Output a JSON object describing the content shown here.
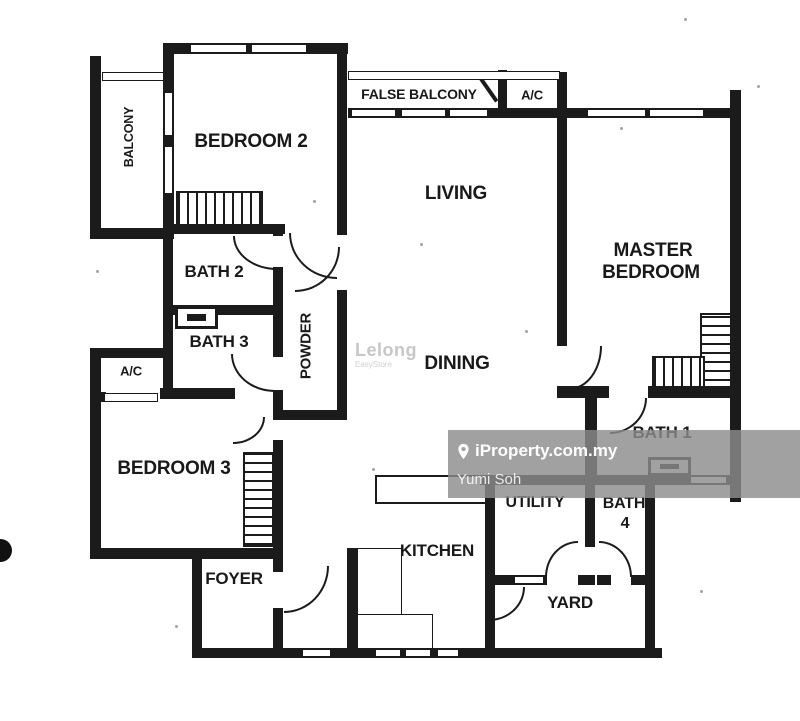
{
  "rooms": {
    "balcony": "BALCONY",
    "bedroom2": "BEDROOM 2",
    "false_balcony": "FALSE BALCONY",
    "ac_top": "A/C",
    "living": "LIVING",
    "master_line1": "MASTER",
    "master_line2": "BEDROOM",
    "bath2": "BATH 2",
    "bath3": "BATH 3",
    "powder": "POWDER",
    "ac_left": "A/C",
    "bedroom3": "BEDROOM 3",
    "dining": "DINING",
    "bath1": "BATH 1",
    "utility": "UTILITY",
    "bath4_line1": "BATH",
    "bath4_line2": "4",
    "kitchen": "KITCHEN",
    "yard": "YARD",
    "foyer": "FOYER"
  },
  "watermarks": {
    "brand": "iProperty.com.my",
    "agent": "Yumi Soh",
    "lelong": "Lelong",
    "lelong_sub": "EasyStore"
  },
  "colors": {
    "wall": "#1b1b1b",
    "paper": "#ffffff",
    "watermark_band": "rgba(140,140,140,0.82)",
    "watermark_text": "#ffffff"
  }
}
